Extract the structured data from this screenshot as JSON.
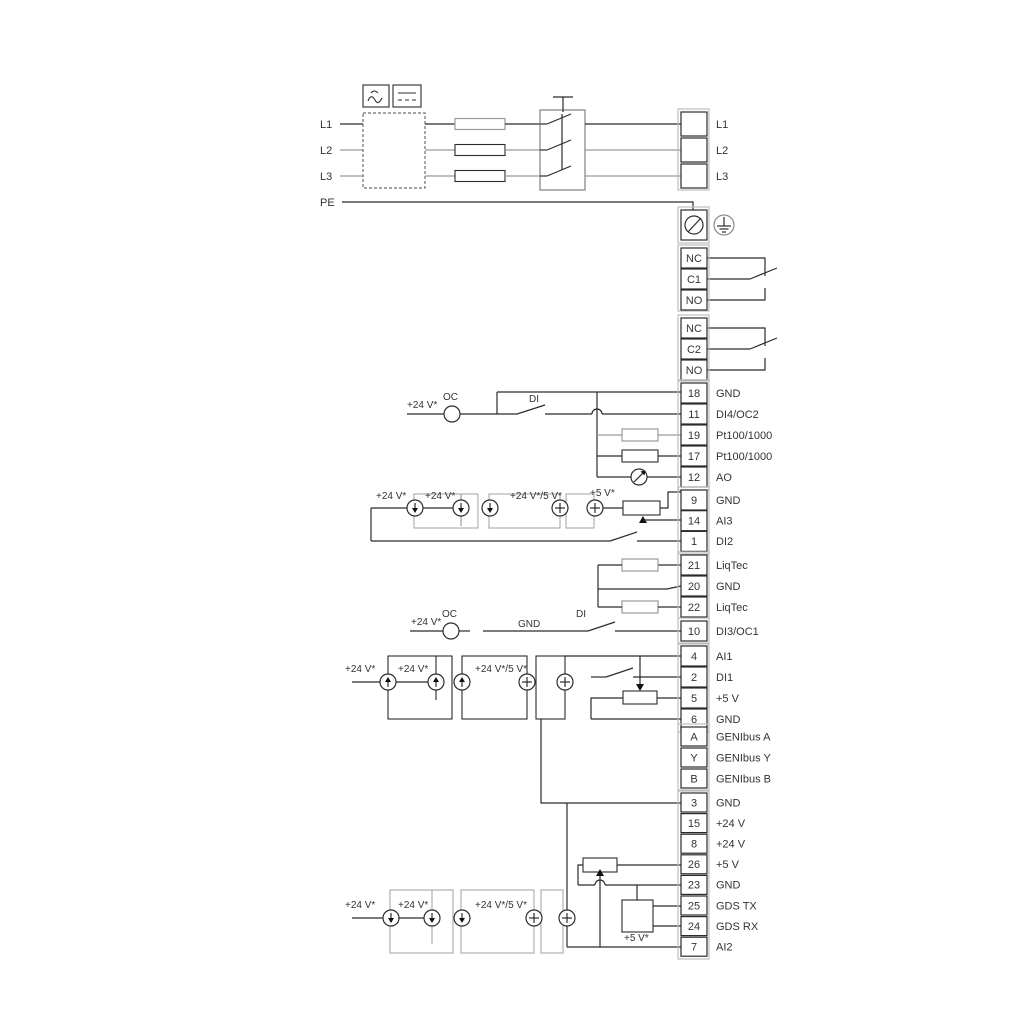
{
  "diagram_title": "drive-wiring-diagram",
  "power": {
    "inputs": [
      "L1",
      "L2",
      "L3"
    ],
    "pe": "PE",
    "outputs": [
      "L1",
      "L2",
      "L3"
    ]
  },
  "relays": [
    {
      "rows": [
        "NC",
        "C1",
        "NO"
      ]
    },
    {
      "rows": [
        "NC",
        "C2",
        "NO"
      ]
    }
  ],
  "groups": {
    "io1": [
      {
        "id": "18",
        "label": "GND"
      },
      {
        "id": "11",
        "label": "DI4/OC2"
      },
      {
        "id": "19",
        "label": "Pt100/1000"
      },
      {
        "id": "17",
        "label": "Pt100/1000"
      },
      {
        "id": "12",
        "label": "AO"
      }
    ],
    "io2": [
      {
        "id": "9",
        "label": "GND"
      },
      {
        "id": "14",
        "label": "AI3"
      },
      {
        "id": "1",
        "label": "DI2"
      }
    ],
    "liqtec": [
      {
        "id": "21",
        "label": "LiqTec"
      },
      {
        "id": "20",
        "label": "GND"
      },
      {
        "id": "22",
        "label": "LiqTec"
      }
    ],
    "io3": [
      {
        "id": "10",
        "label": "DI3/OC1"
      }
    ],
    "io4": [
      {
        "id": "4",
        "label": "AI1"
      },
      {
        "id": "2",
        "label": "DI1"
      },
      {
        "id": "5",
        "label": "+5 V"
      },
      {
        "id": "6",
        "label": "GND"
      }
    ],
    "genibus": [
      {
        "id": "A",
        "label": "GENIbus A"
      },
      {
        "id": "Y",
        "label": "GENIbus Y"
      },
      {
        "id": "B",
        "label": "GENIbus B"
      }
    ],
    "io5": [
      {
        "id": "3",
        "label": "GND"
      },
      {
        "id": "15",
        "label": "+24 V"
      },
      {
        "id": "8",
        "label": "+24 V"
      },
      {
        "id": "26",
        "label": "+5 V"
      },
      {
        "id": "23",
        "label": "GND"
      },
      {
        "id": "25",
        "label": "GDS TX"
      },
      {
        "id": "24",
        "label": "GDS RX"
      },
      {
        "id": "7",
        "label": "AI2"
      }
    ]
  },
  "annotations": {
    "v24": "+24 V*",
    "v24or5": "+24 V*/5 V*",
    "v5": "+5 V*",
    "oc": "OC",
    "di": "DI",
    "gnd": "GND"
  },
  "colors": {
    "wire": "#2b2b2b",
    "wire_gray": "#9b9b9b",
    "background": "#ffffff"
  }
}
